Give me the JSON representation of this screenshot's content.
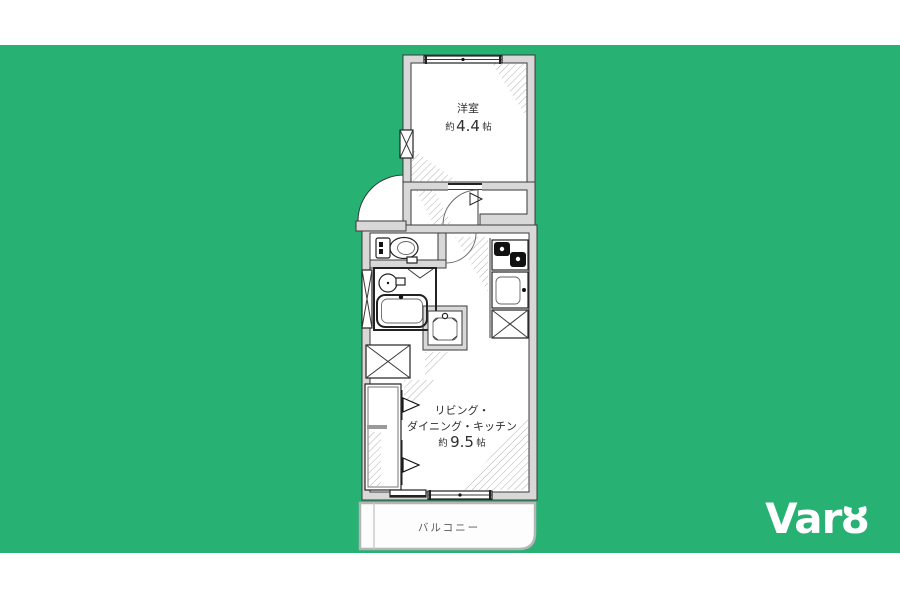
{
  "colors": {
    "background_green": "#27B173",
    "band_white": "#FFFFFF",
    "wall_fill": "#D8D8D8",
    "line": "#3A3A3A",
    "room_fill": "#FFFFFF",
    "logo_white": "#FFFFFF"
  },
  "logo": {
    "text": "Varȣ"
  },
  "floor_plan": {
    "rooms": {
      "bedroom": {
        "name": "洋室",
        "size_prefix": "約",
        "size_value": "4.4",
        "size_unit": "帖"
      },
      "ldk": {
        "name_line1": "リビング・",
        "name_line2": "ダイニング・キッチン",
        "size_prefix": "約",
        "size_value": "9.5",
        "size_unit": "帖"
      },
      "balcony": {
        "name": "バルコニー"
      }
    },
    "fixtures": {
      "toilet": "toilet-icon",
      "bathtub": "bathtub-icon",
      "wash_basin": "wash-basin-icon",
      "vanity": "vanity-icon",
      "gas_stove": "gas-stove-icon",
      "kitchen_sink": "kitchen-sink-icon",
      "refrigerator_space": "x-box-icon",
      "washing_machine_space": "x-box-icon",
      "pipe_space": "x-box-icon",
      "closet": "closet-icon",
      "entrance_door_arc": "door-swing-icon",
      "sliding_window": "window-icon"
    }
  }
}
